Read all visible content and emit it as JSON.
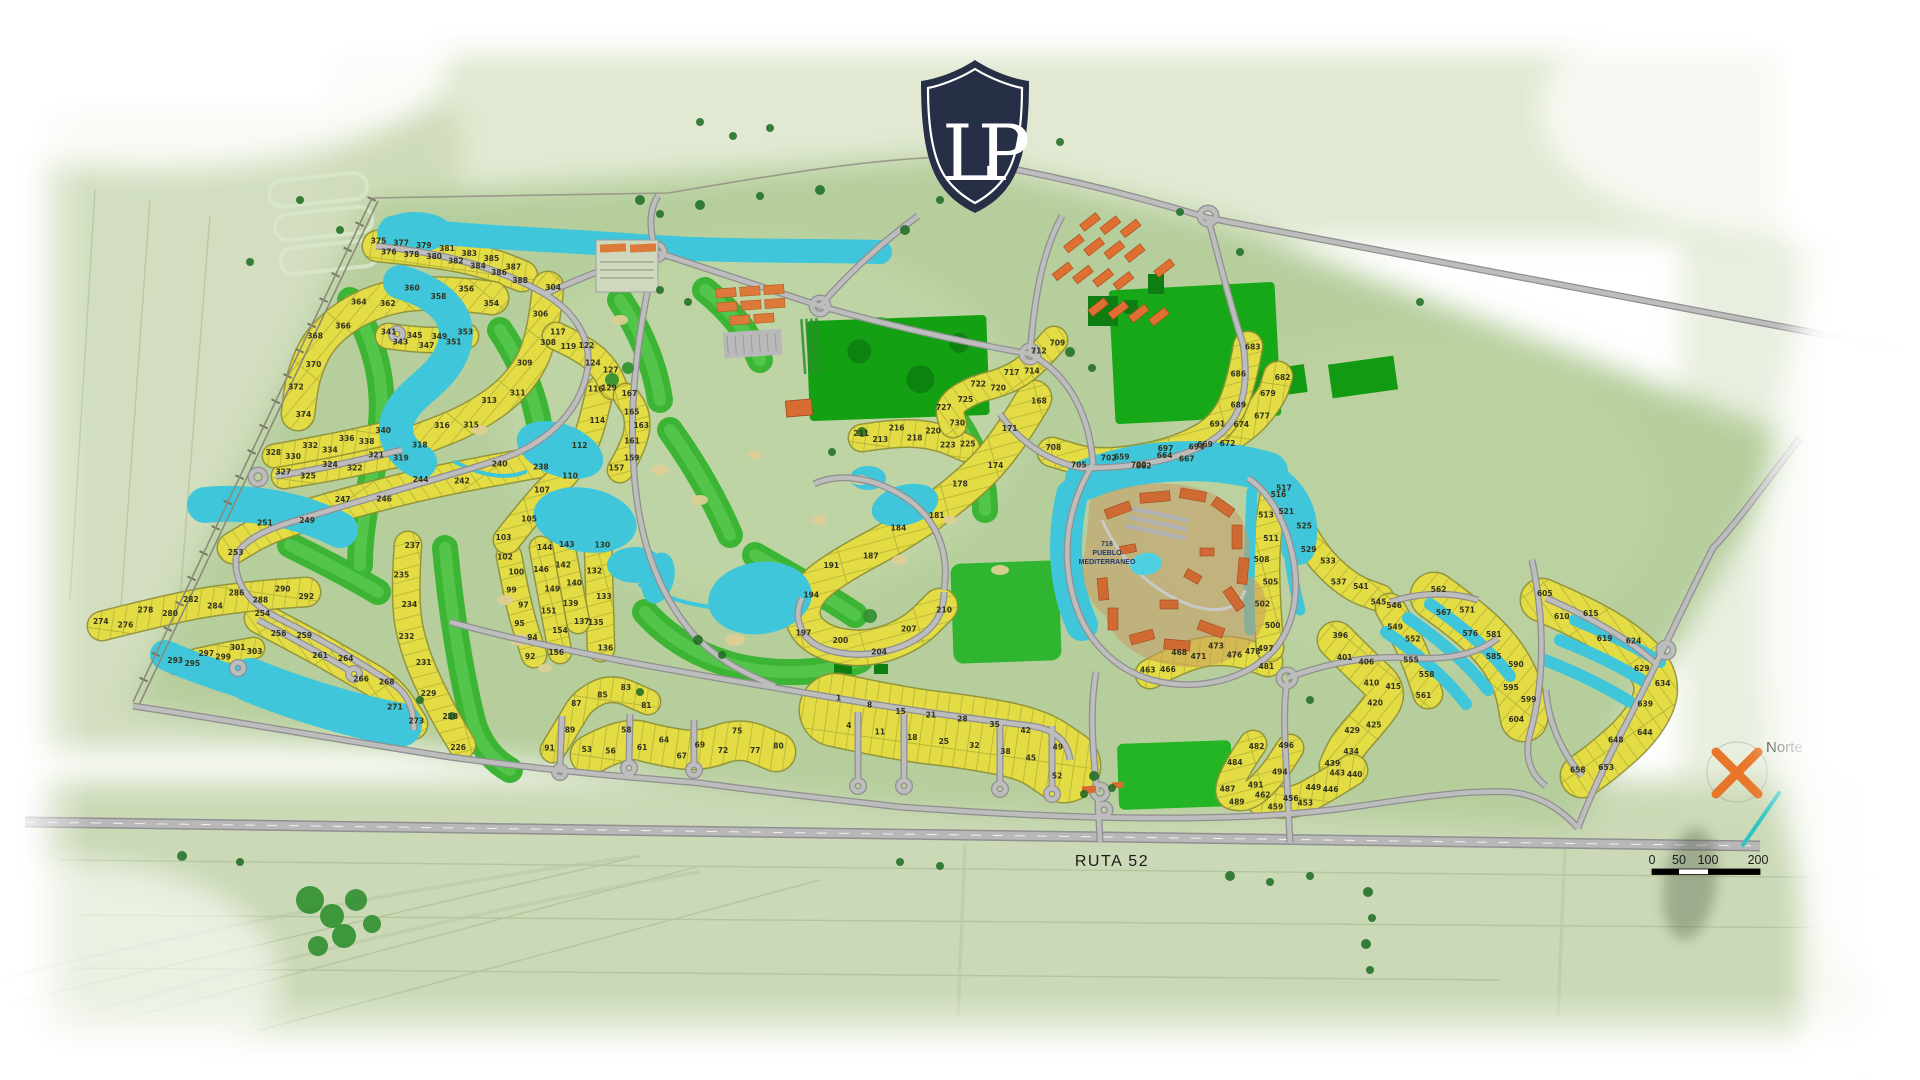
{
  "logo": {
    "monogram": "LP"
  },
  "labels": {
    "north": "Norte",
    "route": "RUTA 52",
    "pueblo_number": "716",
    "pueblo_line1": "PUEBLO",
    "pueblo_line2": "MEDITERRANEO"
  },
  "scale_bar": {
    "ticks": [
      "0",
      "50",
      "100",
      "200"
    ]
  },
  "colors": {
    "water": "#3fc6da",
    "lot_fill": "#e3dc44",
    "lot_edge": "#8f8f33",
    "golf": "#3cb535",
    "golf_light": "#5bcb52",
    "field_dark": "#14a014",
    "base_green": "#b6ce9c",
    "road_fill": "#bdbdbd",
    "road_edge": "#8f8f8f",
    "shield_navy": "#272f47",
    "compass_orange": "#e8762a",
    "terracotta": "#cf6a33",
    "barn_orange": "#e07032"
  },
  "lots": {
    "min": 1,
    "max": 730,
    "clusters": [
      {
        "id": "375-388",
        "from": 375,
        "to": 388,
        "count": 14,
        "w": 30,
        "pat": 0,
        "spine": [
          [
            378,
            246
          ],
          [
            440,
            252
          ],
          [
            492,
            264
          ],
          [
            522,
            276
          ]
        ]
      },
      {
        "id": "354-374",
        "from": 354,
        "to": 374,
        "count": 11,
        "w": 32,
        "pat": 1,
        "spine": [
          [
            492,
            298
          ],
          [
            430,
            290
          ],
          [
            368,
            302
          ],
          [
            322,
            334
          ],
          [
            303,
            374
          ],
          [
            298,
            414
          ]
        ]
      },
      {
        "id": "341-353",
        "from": 341,
        "to": 353,
        "count": 7,
        "w": 24,
        "pat": 0,
        "spine": [
          [
            388,
            336
          ],
          [
            430,
            342
          ],
          [
            466,
            336
          ]
        ]
      },
      {
        "id": "304-318",
        "from": 304,
        "to": 318,
        "count": 9,
        "w": 30,
        "pat": 1,
        "spine": [
          [
            548,
            287
          ],
          [
            543,
            342
          ],
          [
            516,
            388
          ],
          [
            470,
            420
          ],
          [
            418,
            440
          ]
        ]
      },
      {
        "id": "319-327",
        "from": 319,
        "to": 327,
        "count": 6,
        "w": 24,
        "pat": 0,
        "spine": [
          [
            400,
            454
          ],
          [
            345,
            466
          ],
          [
            284,
            476
          ]
        ]
      },
      {
        "id": "328-340",
        "from": 328,
        "to": 340,
        "count": 7,
        "w": 22,
        "pat": 0,
        "spine": [
          [
            274,
            456
          ],
          [
            330,
            446
          ],
          [
            384,
            434
          ]
        ]
      },
      {
        "id": "238-253",
        "from": 238,
        "to": 253,
        "count": 9,
        "w": 30,
        "pat": 2,
        "spine": [
          [
            540,
            462
          ],
          [
            448,
            478
          ],
          [
            352,
            502
          ],
          [
            270,
            526
          ],
          [
            233,
            548
          ]
        ]
      },
      {
        "id": "254-273",
        "from": 254,
        "to": 273,
        "count": 9,
        "w": 30,
        "pat": 2,
        "spine": [
          [
            260,
            618
          ],
          [
            310,
            644
          ],
          [
            352,
            668
          ],
          [
            390,
            690
          ],
          [
            412,
            724
          ]
        ]
      },
      {
        "id": "274-292",
        "from": 274,
        "to": 292,
        "count": 10,
        "w": 28,
        "pat": 0,
        "spine": [
          [
            102,
            626
          ],
          [
            180,
            606
          ],
          [
            250,
            596
          ],
          [
            306,
            592
          ]
        ]
      },
      {
        "id": "293-303",
        "from": 293,
        "to": 303,
        "count": 6,
        "w": 20,
        "pat": 0,
        "spine": [
          [
            176,
            664
          ],
          [
            215,
            655
          ],
          [
            254,
            648
          ]
        ]
      },
      {
        "id": "226-237",
        "from": 237,
        "to": 226,
        "count": 8,
        "w": 26,
        "pat": 3,
        "spine": [
          [
            408,
            545
          ],
          [
            404,
            600
          ],
          [
            414,
            652
          ],
          [
            440,
            708
          ],
          [
            462,
            745
          ]
        ]
      },
      {
        "id": "211-225",
        "from": 211,
        "to": 225,
        "count": 7,
        "w": 26,
        "pat": 0,
        "spine": [
          [
            862,
            438
          ],
          [
            900,
            432
          ],
          [
            938,
            436
          ],
          [
            966,
            448
          ]
        ]
      },
      {
        "id": "81-91",
        "from": 91,
        "to": 81,
        "count": 6,
        "w": 24,
        "pat": 0,
        "spine": [
          [
            553,
            750
          ],
          [
            570,
            722
          ],
          [
            583,
            700
          ],
          [
            612,
            686
          ],
          [
            648,
            702
          ]
        ]
      },
      {
        "id": "92-102",
        "from": 92,
        "to": 102,
        "count": 7,
        "w": 24,
        "pat": 3,
        "spine": [
          [
            534,
            655
          ],
          [
            524,
            625
          ],
          [
            516,
            592
          ],
          [
            509,
            556
          ]
        ]
      },
      {
        "id": "103-116",
        "from": 103,
        "to": 116,
        "count": 7,
        "w": 26,
        "pat": 3,
        "spine": [
          [
            507,
            540
          ],
          [
            540,
            498
          ],
          [
            570,
            470
          ],
          [
            588,
            440
          ],
          [
            600,
            390
          ]
        ]
      },
      {
        "id": "117-129",
        "from": 117,
        "to": 129,
        "count": 6,
        "w": 26,
        "pat": 1,
        "spine": [
          [
            556,
            336
          ],
          [
            586,
            350
          ],
          [
            606,
            370
          ],
          [
            613,
            386
          ]
        ]
      },
      {
        "id": "130-136",
        "from": 130,
        "to": 136,
        "count": 5,
        "w": 26,
        "pat": 3,
        "spine": [
          [
            598,
            545
          ],
          [
            601,
            648
          ]
        ]
      },
      {
        "id": "137-143",
        "from": 143,
        "to": 137,
        "count": 5,
        "w": 22,
        "pat": 3,
        "spine": [
          [
            563,
            545
          ],
          [
            578,
            622
          ]
        ]
      },
      {
        "id": "144-156",
        "from": 144,
        "to": 156,
        "count": 6,
        "w": 22,
        "pat": 3,
        "spine": [
          [
            541,
            548
          ],
          [
            560,
            652
          ]
        ]
      },
      {
        "id": "157-167",
        "from": 157,
        "to": 167,
        "count": 6,
        "w": 24,
        "pat": 3,
        "spine": [
          [
            620,
            470
          ],
          [
            636,
            442
          ],
          [
            638,
            414
          ],
          [
            626,
            396
          ]
        ]
      },
      {
        "id": "53-80",
        "from": 53,
        "to": 80,
        "count": 11,
        "w": 38,
        "pat": 0,
        "spine": [
          [
            590,
            755
          ],
          [
            624,
            736
          ],
          [
            660,
            746
          ],
          [
            700,
            752
          ],
          [
            740,
            737
          ],
          [
            776,
            752
          ]
        ]
      },
      {
        "id": "1-52",
        "from": 1,
        "to": 52,
        "count": 16,
        "w": 72,
        "pat": 0,
        "spine": [
          [
            836,
            710
          ],
          [
            900,
            724
          ],
          [
            970,
            732
          ],
          [
            1032,
            744
          ],
          [
            1064,
            766
          ]
        ]
      },
      {
        "id": "168-210",
        "from": 168,
        "to": 210,
        "count": 14,
        "w": 34,
        "pat": 3,
        "spine": [
          [
            1034,
            398
          ],
          [
            1005,
            448
          ],
          [
            958,
            494
          ],
          [
            900,
            534
          ],
          [
            840,
            566
          ],
          [
            806,
            592
          ],
          [
            800,
            622
          ],
          [
            824,
            644
          ],
          [
            868,
            650
          ],
          [
            912,
            634
          ],
          [
            940,
            606
          ]
        ]
      },
      {
        "id": "396-439",
        "from": 396,
        "to": 439,
        "count": 10,
        "w": 36,
        "pat": 1,
        "spine": [
          [
            1336,
            640
          ],
          [
            1364,
            668
          ],
          [
            1390,
            692
          ],
          [
            1372,
            718
          ],
          [
            1348,
            744
          ],
          [
            1338,
            766
          ]
        ]
      },
      {
        "id": "440-462",
        "from": 440,
        "to": 462,
        "count": 8,
        "w": 30,
        "pat": 0,
        "spine": [
          [
            1352,
            770
          ],
          [
            1320,
            790
          ],
          [
            1292,
            804
          ],
          [
            1262,
            800
          ]
        ]
      },
      {
        "id": "463-481",
        "from": 463,
        "to": 481,
        "count": 8,
        "w": 28,
        "pat": 0,
        "spine": [
          [
            1150,
            674
          ],
          [
            1190,
            652
          ],
          [
            1235,
            650
          ],
          [
            1268,
            662
          ]
        ]
      },
      {
        "id": "482-496",
        "from": 482,
        "to": 496,
        "count": 7,
        "w": 26,
        "pat": 3,
        "spine": [
          [
            1253,
            744
          ],
          [
            1220,
            792
          ],
          [
            1246,
            800
          ],
          [
            1272,
            776
          ],
          [
            1290,
            748
          ]
        ]
      },
      {
        "id": "497-516",
        "from": 497,
        "to": 516,
        "count": 8,
        "w": 26,
        "pat": 3,
        "spine": [
          [
            1270,
            648
          ],
          [
            1266,
            595
          ],
          [
            1266,
            542
          ],
          [
            1274,
            494
          ]
        ]
      },
      {
        "id": "517-545",
        "from": 517,
        "to": 545,
        "count": 8,
        "w": 26,
        "pat": 1,
        "spine": [
          [
            1280,
            490
          ],
          [
            1300,
            528
          ],
          [
            1322,
            562
          ],
          [
            1352,
            588
          ],
          [
            1380,
            598
          ]
        ]
      },
      {
        "id": "546-561",
        "from": 546,
        "to": 561,
        "count": 6,
        "w": 28,
        "pat": 1,
        "spine": [
          [
            1390,
            608
          ],
          [
            1408,
            640
          ],
          [
            1420,
            670
          ],
          [
            1428,
            694
          ]
        ]
      },
      {
        "id": "562-604",
        "from": 562,
        "to": 604,
        "count": 10,
        "w": 46,
        "pat": 1,
        "spine": [
          [
            1434,
            596
          ],
          [
            1470,
            622
          ],
          [
            1500,
            652
          ],
          [
            1518,
            684
          ],
          [
            1524,
            718
          ]
        ]
      },
      {
        "id": "605-658",
        "from": 605,
        "to": 658,
        "count": 12,
        "w": 42,
        "pat": 2,
        "spine": [
          [
            1542,
            600
          ],
          [
            1584,
            618
          ],
          [
            1624,
            642
          ],
          [
            1652,
            668
          ],
          [
            1658,
            696
          ],
          [
            1638,
            730
          ],
          [
            1604,
            760
          ],
          [
            1582,
            776
          ]
        ]
      },
      {
        "id": "659-682",
        "from": 659,
        "to": 682,
        "count": 10,
        "w": 28,
        "pat": 0,
        "spine": [
          [
            1122,
            462
          ],
          [
            1165,
            460
          ],
          [
            1210,
            448
          ],
          [
            1248,
            426
          ],
          [
            1272,
            396
          ],
          [
            1278,
            376
          ]
        ]
      },
      {
        "id": "683-708",
        "from": 683,
        "to": 708,
        "count": 10,
        "w": 28,
        "pat": 3,
        "spine": [
          [
            1248,
            346
          ],
          [
            1240,
            392
          ],
          [
            1220,
            428
          ],
          [
            1185,
            448
          ],
          [
            1140,
            460
          ],
          [
            1092,
            464
          ],
          [
            1052,
            452
          ]
        ]
      },
      {
        "id": "709-730",
        "from": 709,
        "to": 730,
        "count": 9,
        "w": 26,
        "pat": 2,
        "spine": [
          [
            1054,
            340
          ],
          [
            1032,
            366
          ],
          [
            1004,
            382
          ],
          [
            972,
            390
          ],
          [
            948,
            406
          ],
          [
            953,
            424
          ]
        ]
      }
    ]
  }
}
